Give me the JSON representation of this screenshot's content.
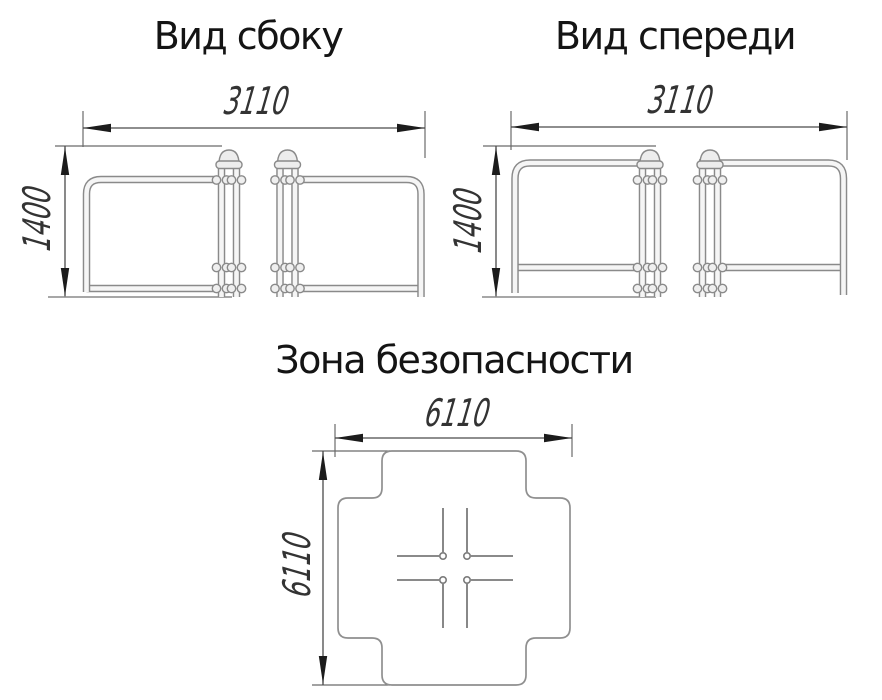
{
  "titles": {
    "side_view": "Вид сбоку",
    "front_view": "Вид спереди",
    "safety_zone": "Зона безопасности"
  },
  "dimensions": {
    "side_view": {
      "width_mm": "3110",
      "height_mm": "1400"
    },
    "front_view": {
      "width_mm": "3110",
      "height_mm": "1400"
    },
    "safety_zone": {
      "width_mm": "6110",
      "depth_mm": "6110"
    }
  },
  "colors": {
    "background": "#ffffff",
    "structure_line": "#8a8a8a",
    "dimension_line": "#4a4a4a",
    "arrow": "#1c1c1c",
    "title_text": "#141414",
    "dimension_text": "#333333"
  }
}
